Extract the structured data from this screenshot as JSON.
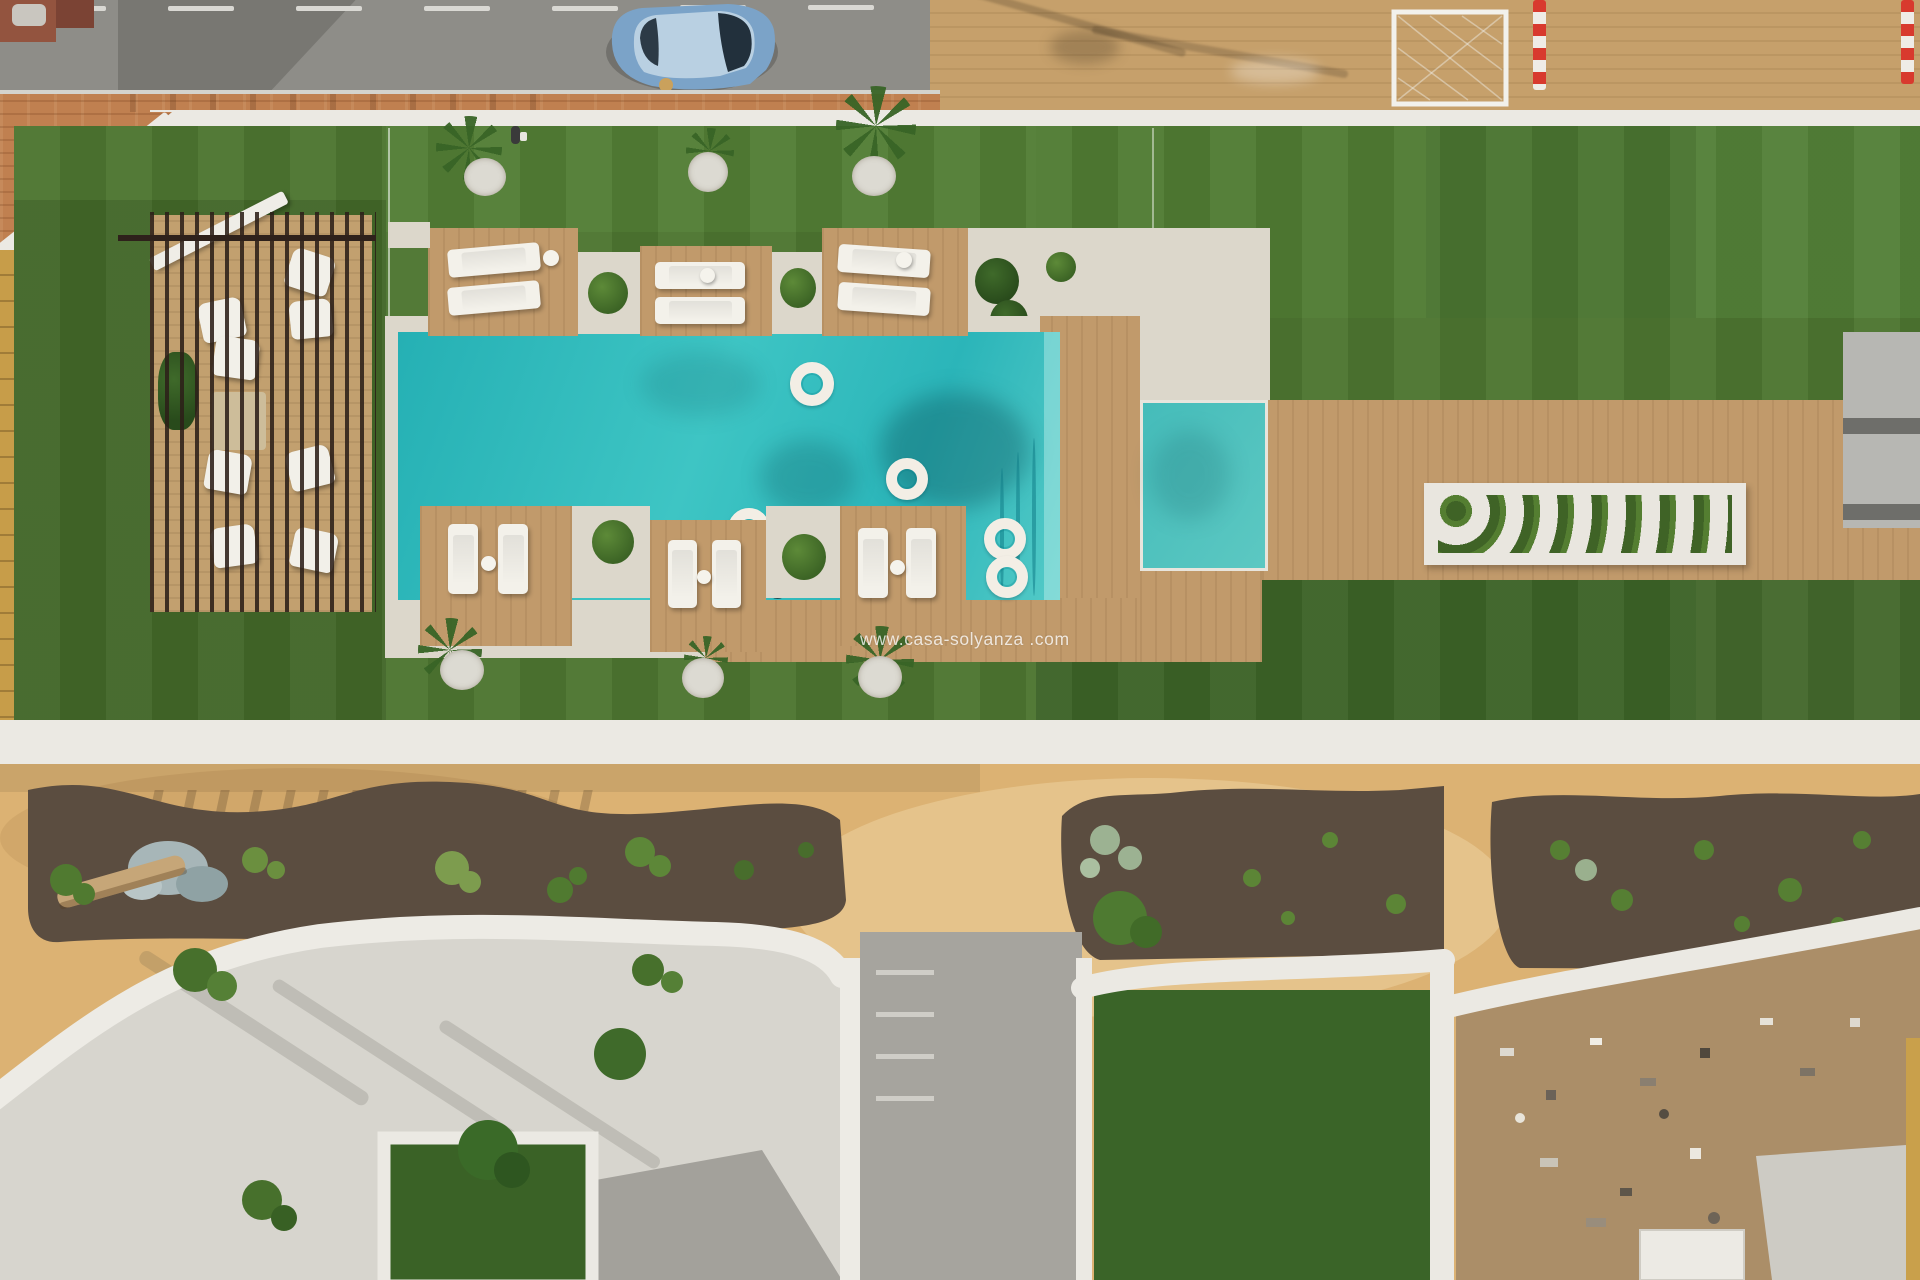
{
  "watermark": {
    "text": "www.casa-solyanza .com"
  },
  "scene": {
    "type": "aerial-drone-photo",
    "description": "Top-down aerial view of a resort-style communal garden: street with parked blue car at top, white perimeter wall, artificial turf lawns, slatted pergola lounge deck, turquoise pool with white ring floats and six timber lounger platforms, long right-hand timber deck with white planter, and a sandy south garden with mulch planting beds and white curved patio walls",
    "street": {
      "road": "grey asphalt with dashed white centre line",
      "parked_car": "blue hatchback",
      "sidewalk": "terracotta brick paving",
      "goal_frame": "white goal frame with net on tan paving",
      "barrier_poles": "red-and-white striped poles"
    },
    "pool_area": {
      "main_pool": "turquoise rectangle with curved corner steps",
      "float_rings": 6,
      "plunge_pool": "small second pool on right deck",
      "lounger_platforms": 6,
      "sun_loungers_on_platforms": 12,
      "side_tables": 6,
      "swimmer": 1
    },
    "pergola": {
      "loungers": 8,
      "mat": "beige rug",
      "structure": "dark timber slats over decking"
    },
    "lawn": {
      "gravel_circles": 6,
      "palms_and_grasses": 7,
      "pedestrian": 1
    },
    "right_terrace": {
      "planter": "long white planter with clipped shrubs",
      "grey_structure": "stepped grey balcony unit"
    },
    "south_garden": {
      "ground": "ochre sand",
      "mulch_beds": 3,
      "bed_contents": "agaves, grasses, rock cluster, fallen palm trunk, pale succulents",
      "patios": "white curved privacy walls, white gravel, lawn squares, grey concrete pavers",
      "construction_patio": "bare dirt with scattered debris and small white shed"
    }
  },
  "palette": {
    "asphalt": "#8e8d88",
    "brick": "#c08050",
    "tan_paving": "#c6a06b",
    "white_wall": "#ebe9e3",
    "turf": "#4d7530",
    "turf_dark": "#3c6327",
    "pool_water": "#2bb5b9",
    "deck_wood": "#c19a6b",
    "sand": "#d8b273",
    "mulch": "#5b4d40",
    "gravel": "#d7d5ce",
    "car_blue": "#7ba3c8",
    "stripe_red": "#d83a2e",
    "float_white": "#f3eee5"
  }
}
